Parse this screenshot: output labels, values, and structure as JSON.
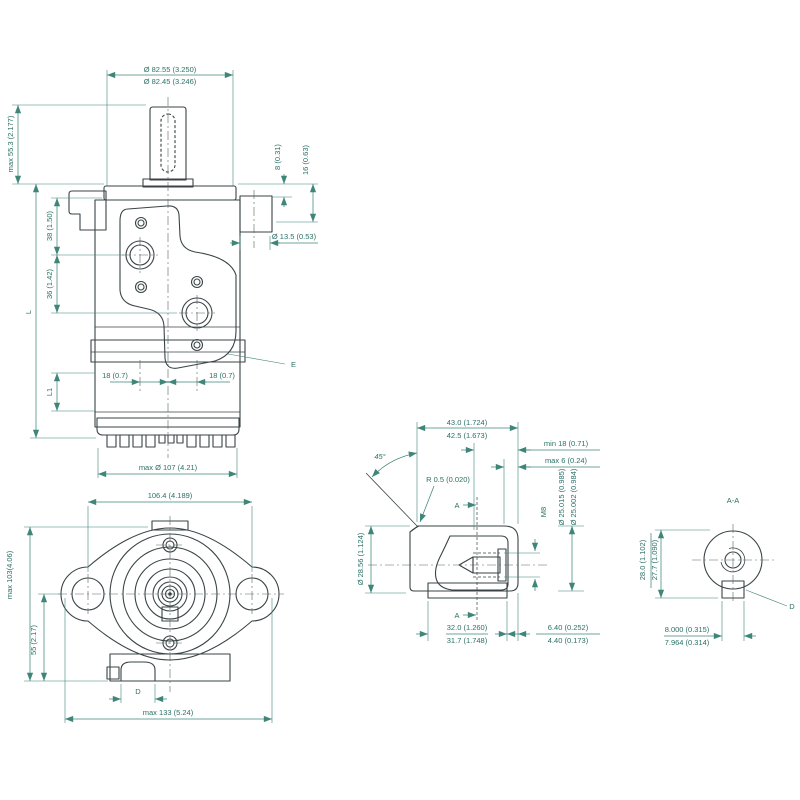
{
  "colors": {
    "body": "#8ca5a3",
    "light": "#c7d3d1",
    "mid": "#a3b7b5",
    "dark": "#7f9a98",
    "outline": "#3a4446",
    "dimension_line": "#3f8579",
    "dimension_text": "#2b7066"
  },
  "views": {
    "side": {
      "dia_top_upper": "Ø 82.55 (3.250)",
      "dia_top_lower": "Ø 82.45 (3.246)",
      "max_height": "max 55.3 (2.177)",
      "dim_8": "8 (0.31)",
      "dim_16": "16 (0.63)",
      "dim_38": "38 (1.50)",
      "dim_36": "36 (1.42)",
      "length_l": "L",
      "length_l1": "L1",
      "port_dia": "Ø 13.5 (0.53)",
      "port_left": "18 (0.7)",
      "port_right": "18 (0.7)",
      "label_e": "E",
      "max_dia": "max Ø 107 (4.21)"
    },
    "front": {
      "bolt_spacing": "106.4 (4.189)",
      "max_height": "max 103(4.06)",
      "dim_55": "55 (2.17)",
      "label_d": "D",
      "max_width": "max 133 (5.24)"
    },
    "shaft": {
      "len_upper": "43.0 (1.724)",
      "len_lower": "42.5 (1.673)",
      "min_depth": "min 18 (0.71)",
      "max_depth": "max 6 (0.24)",
      "angle": "45°",
      "radius": "R 0.5 (0.020)",
      "a_top": "A",
      "a_bottom": "A",
      "thread": "M8",
      "dia_upper": "Ø 25.015 (0.985)",
      "dia_lower": "Ø 25.002 (0.984)",
      "pilot_dia": "Ø 28.56 (1.124)",
      "key_upper": "32.0 (1.260)",
      "key_lower": "31.7 (1.748)",
      "end_upper": "6.40 (0.252)",
      "end_lower": "4.40 (0.173)"
    },
    "aa": {
      "title": "A-A",
      "h_upper": "28.0 (1.102)",
      "h_lower": "27.7 (1.090)",
      "w_upper": "8.000 (0.315)",
      "w_lower": "7.964 (0.314)",
      "label_d": "D"
    }
  }
}
